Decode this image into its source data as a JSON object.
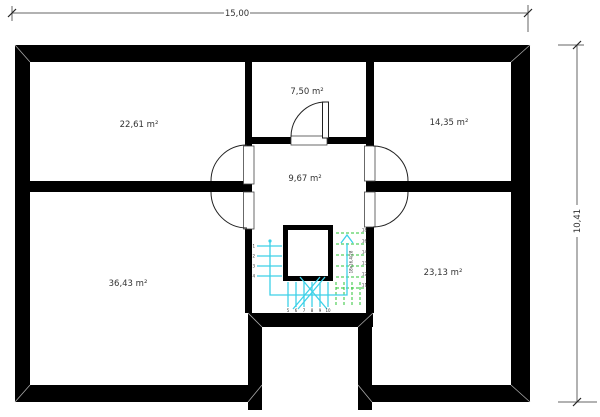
{
  "plan": {
    "title": "attic floor plan",
    "dimensions": {
      "width_label": "15,00",
      "height_label": "10,41"
    },
    "rooms": {
      "top_left": "22,61 m²",
      "top_middle": "7,50 m²",
      "top_right": "14,35 m²",
      "hall": "9,67 m²",
      "bottom_left": "36,43 m²",
      "bottom_right": "23,13 m²"
    },
    "stairs": {
      "annotation": "18x16,4/28",
      "left_steps": [
        "1",
        "2",
        "3",
        "4"
      ],
      "bottom_steps": [
        "5",
        "6",
        "7",
        "8",
        "9",
        "10"
      ],
      "right_steps": [
        "18",
        "16",
        "14",
        "13",
        "12",
        "11"
      ]
    },
    "colors": {
      "wall": "#000000",
      "stair_walkline": "#3dd1e8",
      "stair_hidden_steps": "#2ec437",
      "dimension_line": "#666666",
      "label_text": "#333333"
    }
  }
}
